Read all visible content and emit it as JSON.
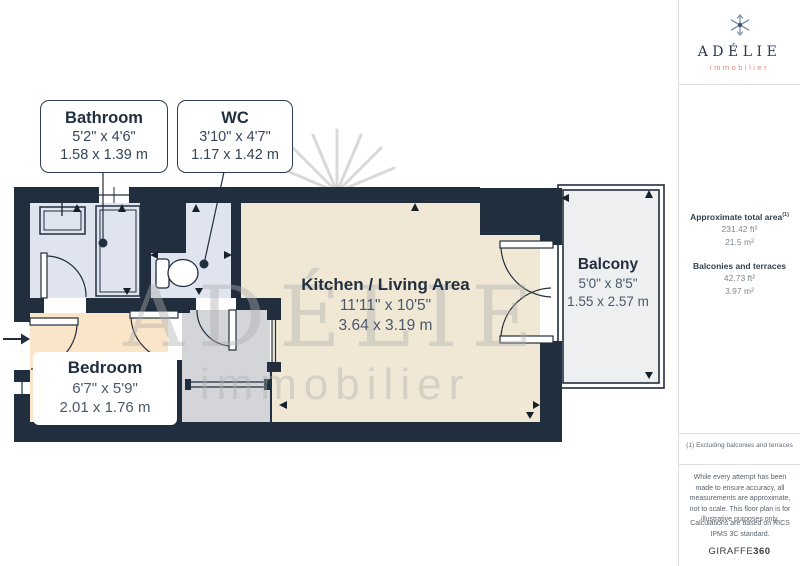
{
  "brand": {
    "name": "ADÉLIE",
    "tagline": "immobilier"
  },
  "watermark": {
    "line1": "ADÉLIE",
    "line2": "immobilier"
  },
  "callouts": {
    "bathroom": {
      "title": "Bathroom",
      "imperial": "5'2\" x 4'6\"",
      "metric": "1.58 x 1.39 m"
    },
    "wc": {
      "title": "WC",
      "imperial": "3'10\" x 4'7\"",
      "metric": "1.17 x 1.42 m"
    }
  },
  "rooms": {
    "kitchen_living": {
      "title": "Kitchen / Living Area",
      "imperial": "11'11\" x 10'5\"",
      "metric": "3.64 x 3.19 m"
    },
    "bedroom": {
      "title": "Bedroom",
      "imperial": "6'7\" x 5'9\"",
      "metric": "2.01 x 1.76 m"
    },
    "balcony": {
      "title": "Balcony",
      "imperial": "5'0\" x 8'5\"",
      "metric": "1.55 x 2.57 m"
    }
  },
  "sidebar": {
    "total_area_label": "Approximate total area",
    "total_area_footnote_marker": "(1)",
    "total_area_imperial": "231.42 ft²",
    "total_area_metric": "21.5 m²",
    "balconies_label": "Balconies and terraces",
    "balconies_imperial": "42.73 ft²",
    "balconies_metric": "3.97 m²",
    "footnote": "(1) Excluding balconies and terraces",
    "disclaimer_1": "While every attempt has been made to ensure accuracy, all measurements are approximate, not to scale. This floor plan is for illustrative purposes only.",
    "disclaimer_2": "Calculations are based on RICS IPMS 3C standard.",
    "generator_brand": "GIRAFFE",
    "generator_brand_suffix": "360"
  },
  "colors": {
    "wall": "#212e3d",
    "kitchen_floor": "#f0e8d4",
    "bedroom_floor": "#fbe5c8",
    "wet_room_floor": "#dfe4ee",
    "hallway_floor": "#d3d5d9",
    "balcony_floor": "#edeff1",
    "label_navy": "#2c3b4f",
    "brand_coral": "#dd8a78"
  }
}
